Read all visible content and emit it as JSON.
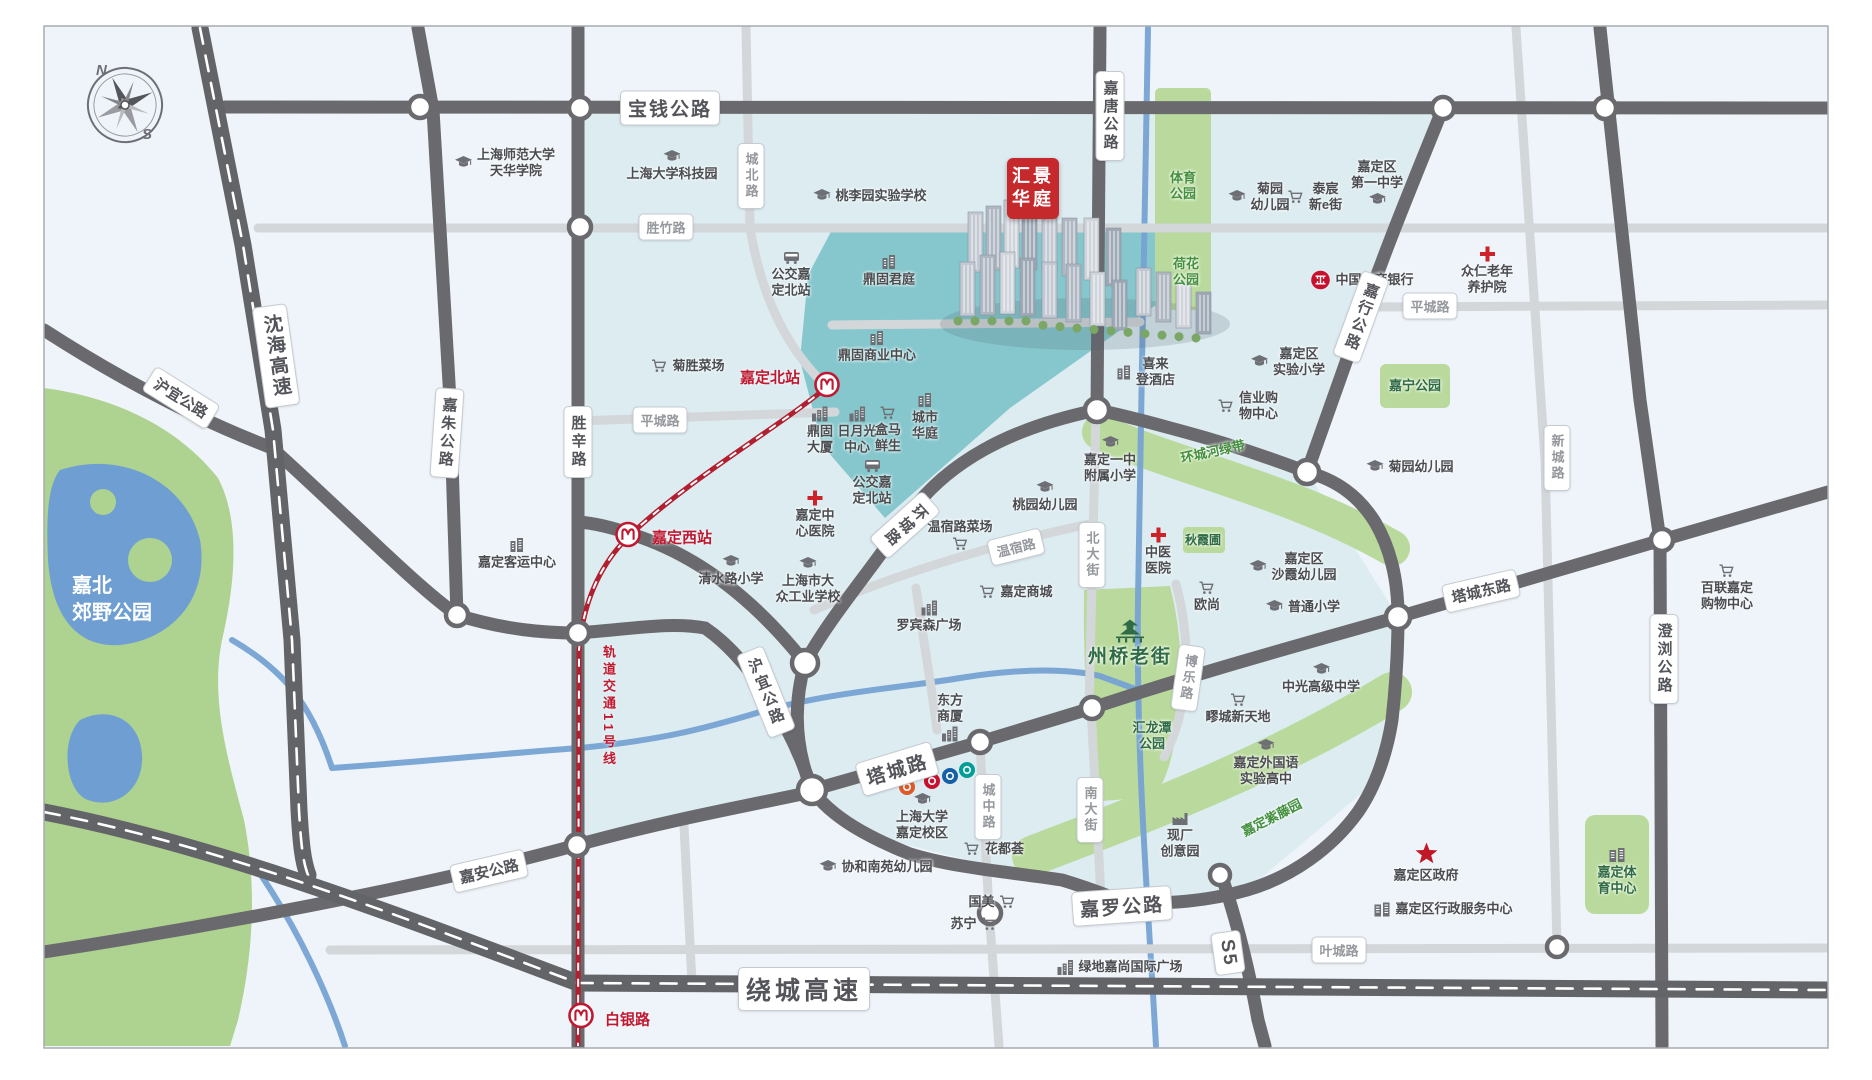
{
  "canvas": {
    "width": 1872,
    "height": 1080
  },
  "colors": {
    "background": "#eef4f9",
    "pale_cyan_zone": "#dcecf1",
    "teal_zone": "#85c7cd",
    "park_green": "#b9da9c",
    "dark_road": "#6a6a6e",
    "light_road": "#d3d7da",
    "river_blue": "#76a3d3",
    "metro_red": "#b02030",
    "project_red": "#c5292c",
    "park_text_green": "#44903e",
    "poi_text": "#4b4c50",
    "red_accent": "#c01830"
  },
  "compass": {
    "north": "N",
    "south": "S"
  },
  "project": {
    "lines": [
      "汇景",
      "华庭"
    ],
    "x": 1007,
    "y": 158
  },
  "metro": {
    "line_label": {
      "text": "轨道交通11号线",
      "x": 599,
      "y": 645
    },
    "stations": [
      {
        "name": "嘉定北站",
        "x": 827,
        "y": 387,
        "label_x": 800,
        "label_y": 377,
        "side": "left"
      },
      {
        "name": "嘉定西站",
        "x": 628,
        "y": 537,
        "label_x": 652,
        "label_y": 537,
        "side": "right"
      },
      {
        "name": "白银路",
        "x": 581,
        "y": 1018,
        "label_x": 605,
        "label_y": 1019,
        "side": "right"
      }
    ]
  },
  "road_labels": [
    {
      "text": "宝钱公路",
      "x": 670,
      "y": 108,
      "rot": 0,
      "vert": false,
      "cls": "hwy-l"
    },
    {
      "text": "嘉唐公路",
      "x": 1110,
      "y": 116,
      "rot": 0,
      "vert": true,
      "cls": "hwy"
    },
    {
      "text": "沈海高速",
      "x": 276,
      "y": 356,
      "rot": -8,
      "vert": true,
      "cls": "hwy-l"
    },
    {
      "text": "沪宜公路",
      "x": 181,
      "y": 398,
      "rot": 32,
      "vert": false,
      "cls": "hwy"
    },
    {
      "text": "嘉朱公路",
      "x": 447,
      "y": 433,
      "rot": 4,
      "vert": true,
      "cls": "hwy"
    },
    {
      "text": "胜辛路",
      "x": 578,
      "y": 442,
      "rot": 0,
      "vert": true,
      "cls": "hwy"
    },
    {
      "text": "胜竹路",
      "x": 666,
      "y": 227,
      "rot": 0,
      "vert": false,
      "cls": "minor"
    },
    {
      "text": "城北路",
      "x": 751,
      "y": 176,
      "rot": 0,
      "vert": true,
      "cls": "minor"
    },
    {
      "text": "平城路",
      "x": 660,
      "y": 420,
      "rot": 0,
      "vert": false,
      "cls": "minor"
    },
    {
      "text": "平城路",
      "x": 1430,
      "y": 306,
      "rot": 0,
      "vert": false,
      "cls": "minor"
    },
    {
      "text": "环城路",
      "x": 905,
      "y": 525,
      "rot": 48,
      "vert": true,
      "cls": "hwy"
    },
    {
      "text": "嘉行公路",
      "x": 1361,
      "y": 317,
      "rot": 20,
      "vert": true,
      "cls": "hwy"
    },
    {
      "text": "温宿路",
      "x": 1016,
      "y": 547,
      "rot": -14,
      "vert": false,
      "cls": "minor"
    },
    {
      "text": "北大街",
      "x": 1092,
      "y": 555,
      "rot": 0,
      "vert": true,
      "cls": "minor"
    },
    {
      "text": "博乐路",
      "x": 1188,
      "y": 678,
      "rot": 8,
      "vert": true,
      "cls": "minor"
    },
    {
      "text": "南大街",
      "x": 1090,
      "y": 810,
      "rot": 0,
      "vert": true,
      "cls": "minor"
    },
    {
      "text": "城中路",
      "x": 988,
      "y": 807,
      "rot": 0,
      "vert": true,
      "cls": "minor"
    },
    {
      "text": "塔城路",
      "x": 897,
      "y": 769,
      "rot": -17,
      "vert": false,
      "cls": "hwy-l"
    },
    {
      "text": "沪宜公路",
      "x": 766,
      "y": 692,
      "rot": -22,
      "vert": true,
      "cls": "hwy"
    },
    {
      "text": "嘉安公路",
      "x": 489,
      "y": 871,
      "rot": -13,
      "vert": false,
      "cls": "hwy"
    },
    {
      "text": "嘉罗公路",
      "x": 1122,
      "y": 906,
      "rot": -4,
      "vert": false,
      "cls": "hwy-l"
    },
    {
      "text": "塔城东路",
      "x": 1481,
      "y": 591,
      "rot": -13,
      "vert": false,
      "cls": "hwy"
    },
    {
      "text": "澄浏公路",
      "x": 1664,
      "y": 659,
      "rot": 0,
      "vert": true,
      "cls": "hwy"
    },
    {
      "text": "新城路",
      "x": 1557,
      "y": 458,
      "rot": 0,
      "vert": true,
      "cls": "minor"
    },
    {
      "text": "叶城路",
      "x": 1339,
      "y": 950,
      "rot": 0,
      "vert": false,
      "cls": "minor"
    },
    {
      "text": "S5",
      "x": 1228,
      "y": 953,
      "rot": 82,
      "vert": false,
      "cls": "hwy-l"
    },
    {
      "text": "绕城高速",
      "x": 804,
      "y": 989,
      "rot": 0,
      "vert": false,
      "cls": "hwy-xl"
    }
  ],
  "pois": [
    {
      "lines": [
        "上海师范大学",
        "天华学院"
      ],
      "x": 505,
      "y": 163,
      "icon": "school-icon",
      "pos": "left"
    },
    {
      "lines": [
        "上海大学科技园"
      ],
      "x": 672,
      "y": 166,
      "icon": "school-icon",
      "pos": "top"
    },
    {
      "lines": [
        "桃李园实验学校"
      ],
      "x": 870,
      "y": 196,
      "icon": "school-icon",
      "pos": "left"
    },
    {
      "lines": [
        "公交嘉",
        "定北站"
      ],
      "x": 791,
      "y": 275,
      "icon": "bus-icon",
      "pos": "top"
    },
    {
      "lines": [
        "鼎固君庭"
      ],
      "x": 889,
      "y": 271,
      "icon": "building-icon",
      "pos": "top"
    },
    {
      "lines": [
        "菊胜菜场"
      ],
      "x": 688,
      "y": 366,
      "icon": "cart-icon",
      "pos": "left"
    },
    {
      "lines": [
        "鼎固商业中心"
      ],
      "x": 877,
      "y": 347,
      "icon": "building-icon",
      "pos": "top"
    },
    {
      "lines": [
        "鼎固",
        "大厦"
      ],
      "x": 820,
      "y": 431,
      "icon": "towers-icon",
      "pos": "top"
    },
    {
      "lines": [
        "日月光",
        "中心"
      ],
      "x": 857,
      "y": 431,
      "icon": "towers-icon",
      "pos": "top"
    },
    {
      "lines": [
        "盒马",
        "鲜生"
      ],
      "x": 888,
      "y": 430,
      "icon": "cart-icon",
      "pos": "top"
    },
    {
      "lines": [
        "城市",
        "华庭"
      ],
      "x": 925,
      "y": 417,
      "icon": "building-icon",
      "pos": "top"
    },
    {
      "lines": [
        "公交嘉",
        "定北站"
      ],
      "x": 872,
      "y": 483,
      "icon": "bus-icon",
      "pos": "top"
    },
    {
      "lines": [
        "嘉定中",
        "心医院"
      ],
      "x": 815,
      "y": 515,
      "icon": "hospital-cross-icon",
      "pos": "top"
    },
    {
      "lines": [
        "清水路小学"
      ],
      "x": 731,
      "y": 571,
      "icon": "school-icon",
      "pos": "top"
    },
    {
      "lines": [
        "上海市大",
        "众工业学校"
      ],
      "x": 808,
      "y": 581,
      "icon": "school-icon",
      "pos": "top"
    },
    {
      "lines": [
        "嘉定客运中心"
      ],
      "x": 517,
      "y": 554,
      "icon": "building-icon",
      "pos": "top"
    },
    {
      "lines": [
        "菊园",
        "幼儿园"
      ],
      "x": 1259,
      "y": 197,
      "icon": "school-icon",
      "pos": "left"
    },
    {
      "lines": [
        "泰宸",
        "新e街"
      ],
      "x": 1315,
      "y": 197,
      "icon": "cart-icon",
      "pos": "left"
    },
    {
      "lines": [
        "嘉定区",
        "第一中学"
      ],
      "x": 1377,
      "y": 183,
      "icon": "school-icon",
      "pos": "bottom"
    },
    {
      "lines": [
        "中国工商银行"
      ],
      "x": 1362,
      "y": 280,
      "icon": "icbc-logo",
      "pos": "left"
    },
    {
      "lines": [
        "众仁老年",
        "养护院"
      ],
      "x": 1487,
      "y": 271,
      "icon": "hospital-cross-icon",
      "pos": "top"
    },
    {
      "lines": [
        "嘉定区",
        "实验小学"
      ],
      "x": 1288,
      "y": 362,
      "icon": "school-icon",
      "pos": "left"
    },
    {
      "lines": [
        "信业购",
        "物中心"
      ],
      "x": 1248,
      "y": 406,
      "icon": "cart-icon",
      "pos": "left"
    },
    {
      "lines": [
        "喜来",
        "登酒店"
      ],
      "x": 1146,
      "y": 372,
      "icon": "building-icon",
      "pos": "left"
    },
    {
      "lines": [
        "嘉定一中",
        "附属小学"
      ],
      "x": 1110,
      "y": 460,
      "icon": "school-icon",
      "pos": "top"
    },
    {
      "lines": [
        "桃园幼儿园"
      ],
      "x": 1045,
      "y": 497,
      "icon": "school-icon",
      "pos": "top"
    },
    {
      "lines": [
        "菊园幼儿园"
      ],
      "x": 1410,
      "y": 467,
      "icon": "school-icon",
      "pos": "left"
    },
    {
      "lines": [
        "温宿路菜场"
      ],
      "x": 960,
      "y": 535,
      "icon": "cart-icon",
      "pos": "bottom"
    },
    {
      "lines": [
        "嘉定商城"
      ],
      "x": 1016,
      "y": 592,
      "icon": "cart-icon",
      "pos": "left"
    },
    {
      "lines": [
        "中医",
        "医院"
      ],
      "x": 1158,
      "y": 552,
      "icon": "hospital-cross-icon",
      "pos": "top"
    },
    {
      "lines": [
        "嘉定区",
        "沙霞幼儿园"
      ],
      "x": 1293,
      "y": 567,
      "icon": "school-icon",
      "pos": "left"
    },
    {
      "lines": [
        "欧尚"
      ],
      "x": 1207,
      "y": 597,
      "icon": "cart-icon",
      "pos": "top"
    },
    {
      "lines": [
        "普通小学"
      ],
      "x": 1303,
      "y": 607,
      "icon": "school-icon",
      "pos": "left"
    },
    {
      "lines": [
        "罗宾森广场"
      ],
      "x": 929,
      "y": 617,
      "icon": "towers-icon",
      "pos": "top"
    },
    {
      "lines": [
        "东方",
        "商厦"
      ],
      "x": 950,
      "y": 717,
      "icon": "towers-icon",
      "pos": "bottom"
    },
    {
      "lines": [
        "中光高级中学"
      ],
      "x": 1321,
      "y": 679,
      "icon": "school-icon",
      "pos": "top"
    },
    {
      "lines": [
        "疁城新天地"
      ],
      "x": 1238,
      "y": 709,
      "icon": "cart-icon",
      "pos": "top"
    },
    {
      "lines": [
        "嘉定外国语",
        "实验高中"
      ],
      "x": 1266,
      "y": 763,
      "icon": "school-icon",
      "pos": "top"
    },
    {
      "lines": [
        "上海大学",
        "嘉定校区"
      ],
      "x": 922,
      "y": 817,
      "icon": "school-icon",
      "pos": "top"
    },
    {
      "lines": [
        "协和南苑幼儿园"
      ],
      "x": 876,
      "y": 867,
      "icon": "school-icon",
      "pos": "left"
    },
    {
      "lines": [
        "花都荟"
      ],
      "x": 994,
      "y": 849,
      "icon": "cart-icon",
      "pos": "left"
    },
    {
      "lines": [
        "国美"
      ],
      "x": 992,
      "y": 902,
      "icon": "cart-icon",
      "pos": "right"
    },
    {
      "lines": [
        "苏宁"
      ],
      "x": 974,
      "y": 924,
      "icon": "cart-icon",
      "pos": "right"
    },
    {
      "lines": [
        "现厂",
        "创意园"
      ],
      "x": 1180,
      "y": 836,
      "icon": "factory-icon",
      "pos": "top"
    },
    {
      "lines": [
        "嘉定区政府"
      ],
      "x": 1426,
      "y": 863,
      "icon": "star-icon",
      "pos": "top"
    },
    {
      "lines": [
        "嘉定区行政服务中心"
      ],
      "x": 1443,
      "y": 909,
      "icon": "gov-building-icon",
      "pos": "left"
    },
    {
      "lines": [
        "绿地嘉尚国际广场"
      ],
      "x": 1120,
      "y": 967,
      "icon": "towers-icon",
      "pos": "left"
    },
    {
      "lines": [
        "百联嘉定",
        "购物中心"
      ],
      "x": 1727,
      "y": 588,
      "icon": "cart-icon",
      "pos": "top"
    }
  ],
  "park_labels": [
    {
      "lines": [
        "体育",
        "公园"
      ],
      "x": 1183,
      "y": 186,
      "cls": "park",
      "icon": "none",
      "rot": 0
    },
    {
      "lines": [
        "荷花",
        "公园"
      ],
      "x": 1186,
      "y": 272,
      "cls": "park",
      "icon": "none",
      "rot": 0
    },
    {
      "lines": [
        "嘉宁公园"
      ],
      "x": 1415,
      "y": 386,
      "cls": "park-dark",
      "icon": "none",
      "rot": 0
    },
    {
      "lines": [
        "环城河绿带"
      ],
      "x": 1213,
      "y": 452,
      "cls": "park",
      "icon": "none",
      "rot": -12
    },
    {
      "lines": [
        "秋霞圃"
      ],
      "x": 1203,
      "y": 540,
      "cls": "park-dark small",
      "icon": "none",
      "rot": 0
    },
    {
      "lines": [
        "汇龙潭",
        "公园"
      ],
      "x": 1152,
      "y": 736,
      "cls": "park-dark",
      "icon": "none",
      "rot": 0
    },
    {
      "lines": [
        "州桥老街"
      ],
      "x": 1130,
      "y": 644,
      "cls": "park-big",
      "icon": "pagoda-icon",
      "rot": 0
    },
    {
      "lines": [
        "嘉定紫藤园"
      ],
      "x": 1272,
      "y": 818,
      "cls": "park",
      "icon": "none",
      "rot": -27
    },
    {
      "lines": [
        "嘉北",
        "郊野公园"
      ],
      "x": 112,
      "y": 600,
      "cls": "park-white",
      "icon": "none",
      "rot": 0
    },
    {
      "lines": [
        "嘉定体",
        "育中心"
      ],
      "x": 1617,
      "y": 872,
      "cls": "park-dark",
      "icon": "gov-building-icon",
      "rot": 0
    }
  ],
  "bank_logos": [
    {
      "x": 907,
      "y": 787,
      "color": "#e05a28"
    },
    {
      "x": 932,
      "y": 781,
      "color": "#c8102e"
    },
    {
      "x": 950,
      "y": 776,
      "color": "#1660a8"
    },
    {
      "x": 967,
      "y": 770,
      "color": "#009e96"
    }
  ]
}
